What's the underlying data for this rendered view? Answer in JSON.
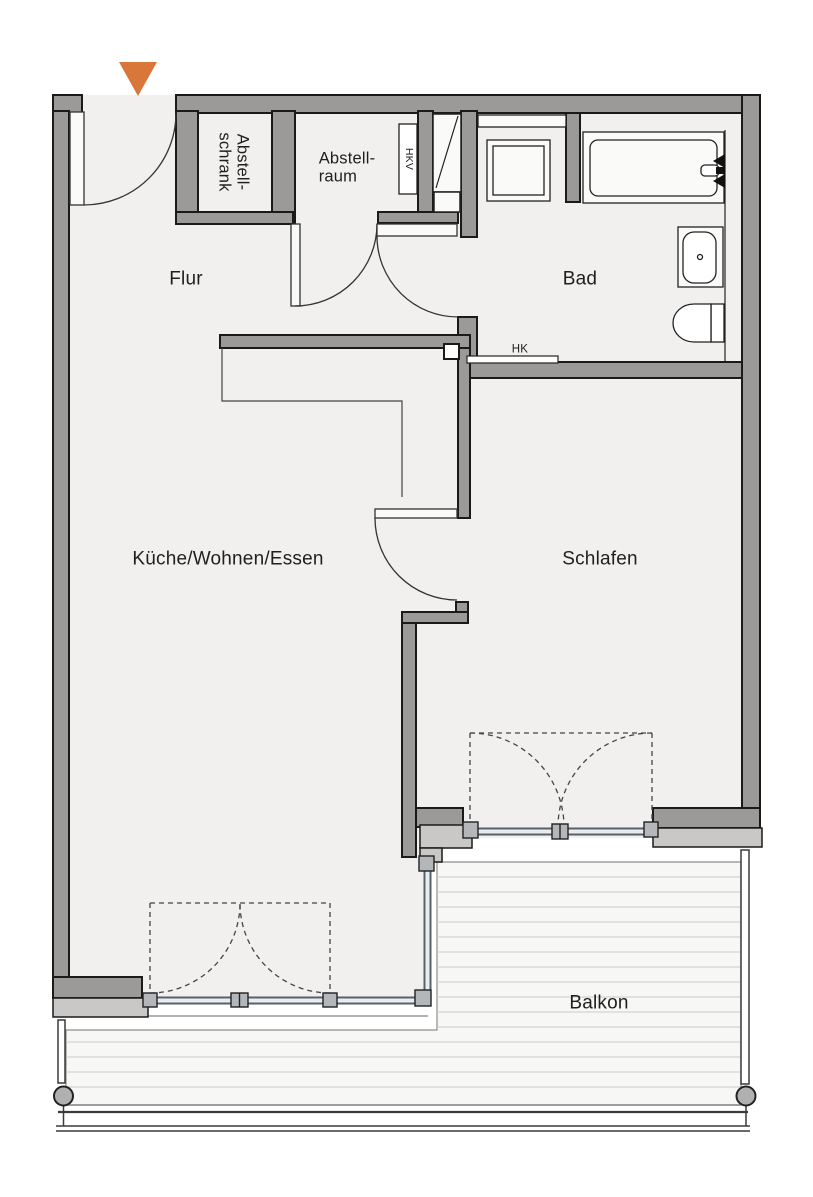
{
  "rooms": [
    {
      "id": "flur",
      "label": "Flur"
    },
    {
      "id": "abstellschrank",
      "label": "Abstell-\nschrank"
    },
    {
      "id": "abstellraum",
      "label": "Abstell-\nraum"
    },
    {
      "id": "bad",
      "label": "Bad"
    },
    {
      "id": "kueche-wohnen-essen",
      "label": "Küche/Wohnen/Essen"
    },
    {
      "id": "schlafen",
      "label": "Schlafen"
    },
    {
      "id": "balkon",
      "label": "Balkon"
    }
  ],
  "annotations": {
    "hkv": "HKV",
    "hk": "HK"
  },
  "colors": {
    "wall": "#9b9a99",
    "wall_light": "#c9c8c6",
    "floor": "#f1f0ee",
    "fixture_fill": "#fafaf9",
    "accent": "#d9763a",
    "glazing": "#52626e",
    "glazing_gap": "#e8eaeb",
    "deck_fill": "#f7f7f6",
    "deck_line": "#cbcbca"
  }
}
